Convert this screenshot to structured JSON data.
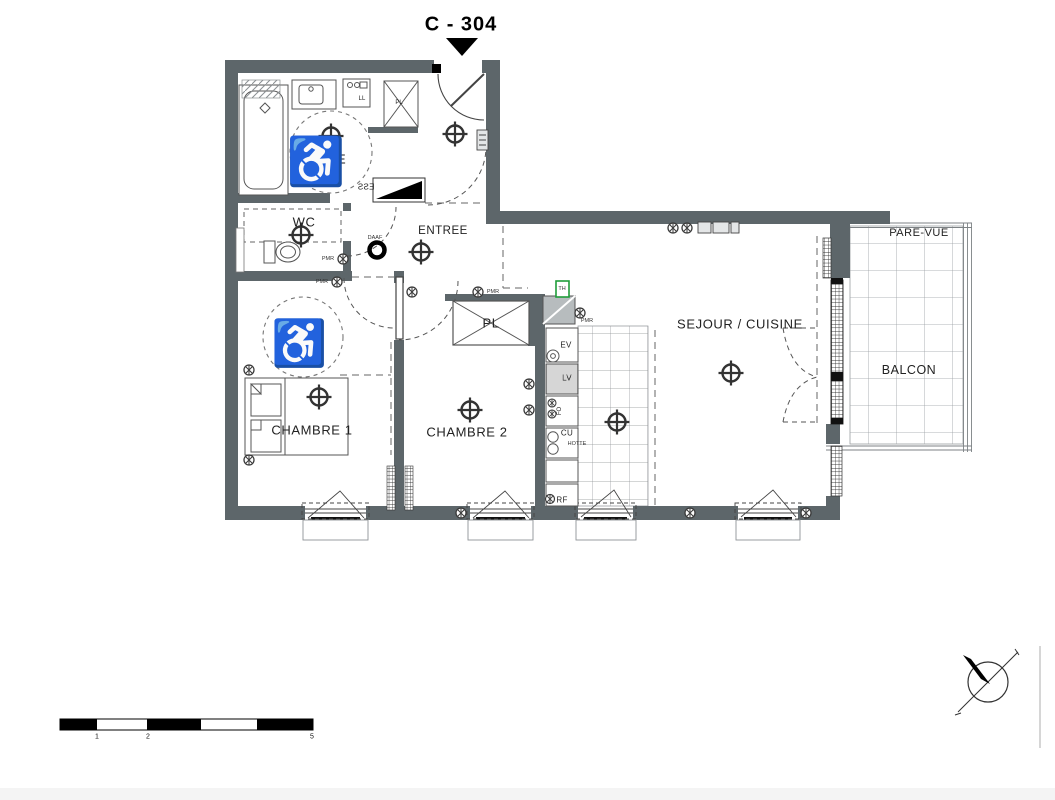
{
  "title": "C - 304",
  "rooms": {
    "sde": "SDE",
    "wc": "WC",
    "entree": "ENTREE",
    "chambre1": "CHAMBRE 1",
    "chambre2": "CHAMBRE 2",
    "sejour_cuisine": "SEJOUR / CUISINE",
    "balcon": "BALCON",
    "pare_vue": "PARE-VUE"
  },
  "equipment": {
    "ll": "LL",
    "pl": "PL",
    "ev": "EV",
    "lv": "LV",
    "fo": "FO",
    "cu": "CU",
    "hotte": "HOTTE",
    "rf": "RF",
    "th": "TH",
    "ess": "ESS",
    "daaf": "DAAF",
    "pmr": "PMR"
  },
  "icons": {
    "wheelchair": "♿"
  },
  "scale_bar": {
    "labels": [
      "1",
      "2",
      "5"
    ]
  },
  "colors": {
    "wall": "#5d666a",
    "line": "#44484b",
    "thermostat_green": "#1f9d3a"
  }
}
